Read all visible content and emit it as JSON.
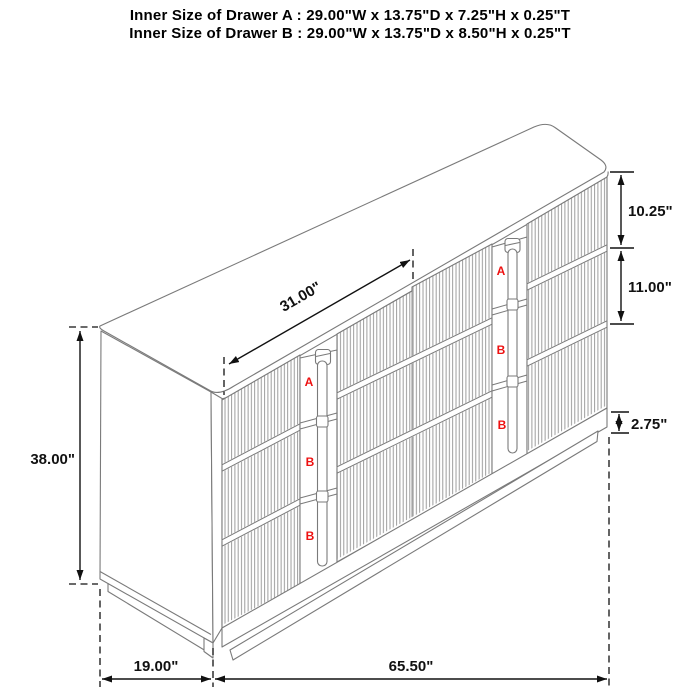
{
  "title": {
    "line1": "Inner Size of Drawer A : 29.00\"W x 13.75\"D x 7.25\"H x 0.25\"T",
    "line2": "Inner Size of Drawer B : 29.00\"W x 13.75\"D x 8.50\"H x 0.25\"T"
  },
  "dimensions": {
    "drawer_span_width": "31.00\"",
    "top_drawer_height": "10.25\"",
    "middle_drawer_height": "11.00\"",
    "base_height": "2.75\"",
    "overall_height": "38.00\"",
    "overall_depth": "19.00\"",
    "overall_width": "65.50\""
  },
  "drawer_labels": {
    "left_column": [
      "A",
      "B",
      "B"
    ],
    "right_column": [
      "A",
      "B",
      "B"
    ]
  },
  "colors": {
    "line": "#7a7a7a",
    "flute": "#929292",
    "dim": "#111111",
    "red": "#ee1111",
    "bg": "#ffffff"
  }
}
